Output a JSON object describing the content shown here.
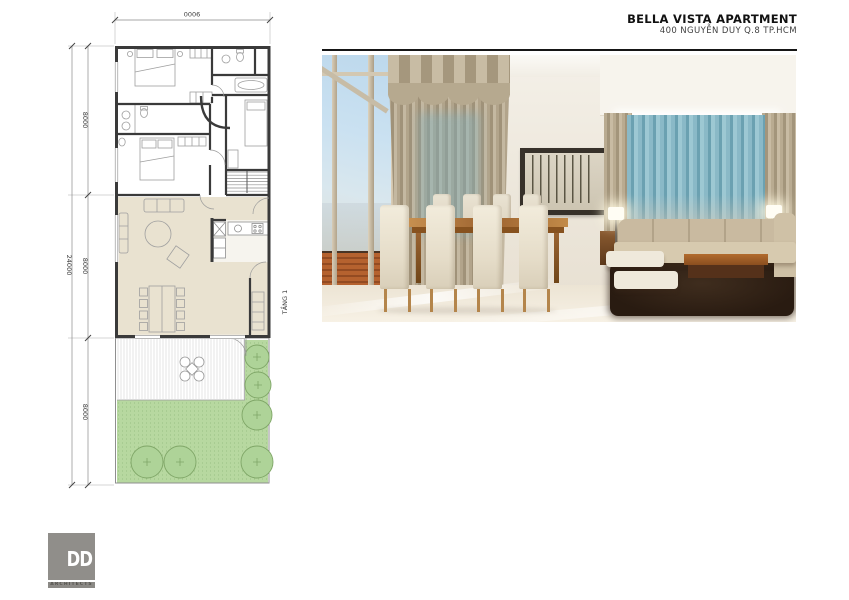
{
  "header": {
    "title": "BELLA VISTA APARTMENT",
    "subtitle": "400 NGUYỄN DUY  Q.8 TP.HCM"
  },
  "plan": {
    "floor_label": "TẦNG 1",
    "dim_top_width": "9000",
    "dim_total_height": "24000",
    "dim_segment_1": "8000",
    "dim_segment_2": "8000",
    "dim_segment_3": "8000",
    "colors": {
      "wall": "#3a3a3a",
      "living_floor": "#e9e2d0",
      "garden_green": "#b7d8a0",
      "tree_outline": "#7fa667",
      "dimension_lines": "#8a8a8a"
    }
  },
  "photo": {
    "alt": "interior-rendering-living-dining-room",
    "colors": {
      "sky": "#c2dcee",
      "curtain_tan": "#ab9d84",
      "curtain_teal": "#7fb2c3",
      "table_wood": "#9d6330",
      "rug_brown": "#2e2014",
      "wall_cream": "#ece6da"
    }
  },
  "logo": {
    "monogram": "DD",
    "caption": "ARCHITECTS"
  }
}
